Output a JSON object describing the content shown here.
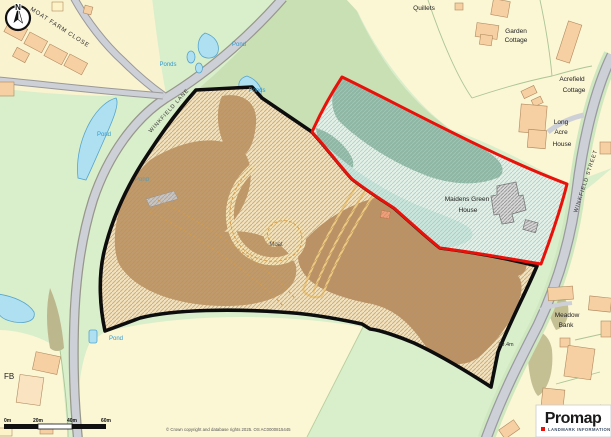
{
  "map": {
    "logo": {
      "brand": "Promap",
      "tagline": "LANDMARK INFORMATION"
    },
    "compass": {
      "north": "N"
    },
    "roads": {
      "moat_farm_close": "MOAT FARM CLOSE",
      "winkfield_lane": "WINKFIELD LANE",
      "winkfield_street": "WINKFIELD STREET"
    },
    "places": {
      "quillets": "Quillets",
      "garden_cottage": [
        "Garden",
        "Cottage"
      ],
      "acrefield_cottage": [
        "Acrefield",
        "Cottage"
      ],
      "long_acre_house": [
        "Long",
        "Acre",
        "House"
      ],
      "maidens_green_house": [
        "Maidens Green",
        "House"
      ],
      "moat": "Moat",
      "meadow_bank": [
        "Meadow",
        "Bank"
      ],
      "toonagh": "Toonagh",
      "fb": "FB",
      "spot_height": "89.4m"
    },
    "water": {
      "pond": "Pond",
      "ponds": "Ponds"
    },
    "scale": {
      "ticks": [
        "0m",
        "20m",
        "40m",
        "60m"
      ]
    },
    "copyright": "© Crown copyright and database rights 2025. OS AC0000815445",
    "colors": {
      "field_green": "#d9eecb",
      "field_yellow": "#fbf6d4",
      "sage": "#c9dfb4",
      "water": "#aee0f2",
      "road": "#ced0d8",
      "building": "#f6cfa3",
      "plot_base": "#f0e3c4",
      "plot_brown": "#bf9a6e",
      "plot_hatch": "#c89045",
      "woodland": "#8fb5a3",
      "red_boundary": "#e8120a",
      "black_boundary": "#0d0d0d"
    }
  }
}
